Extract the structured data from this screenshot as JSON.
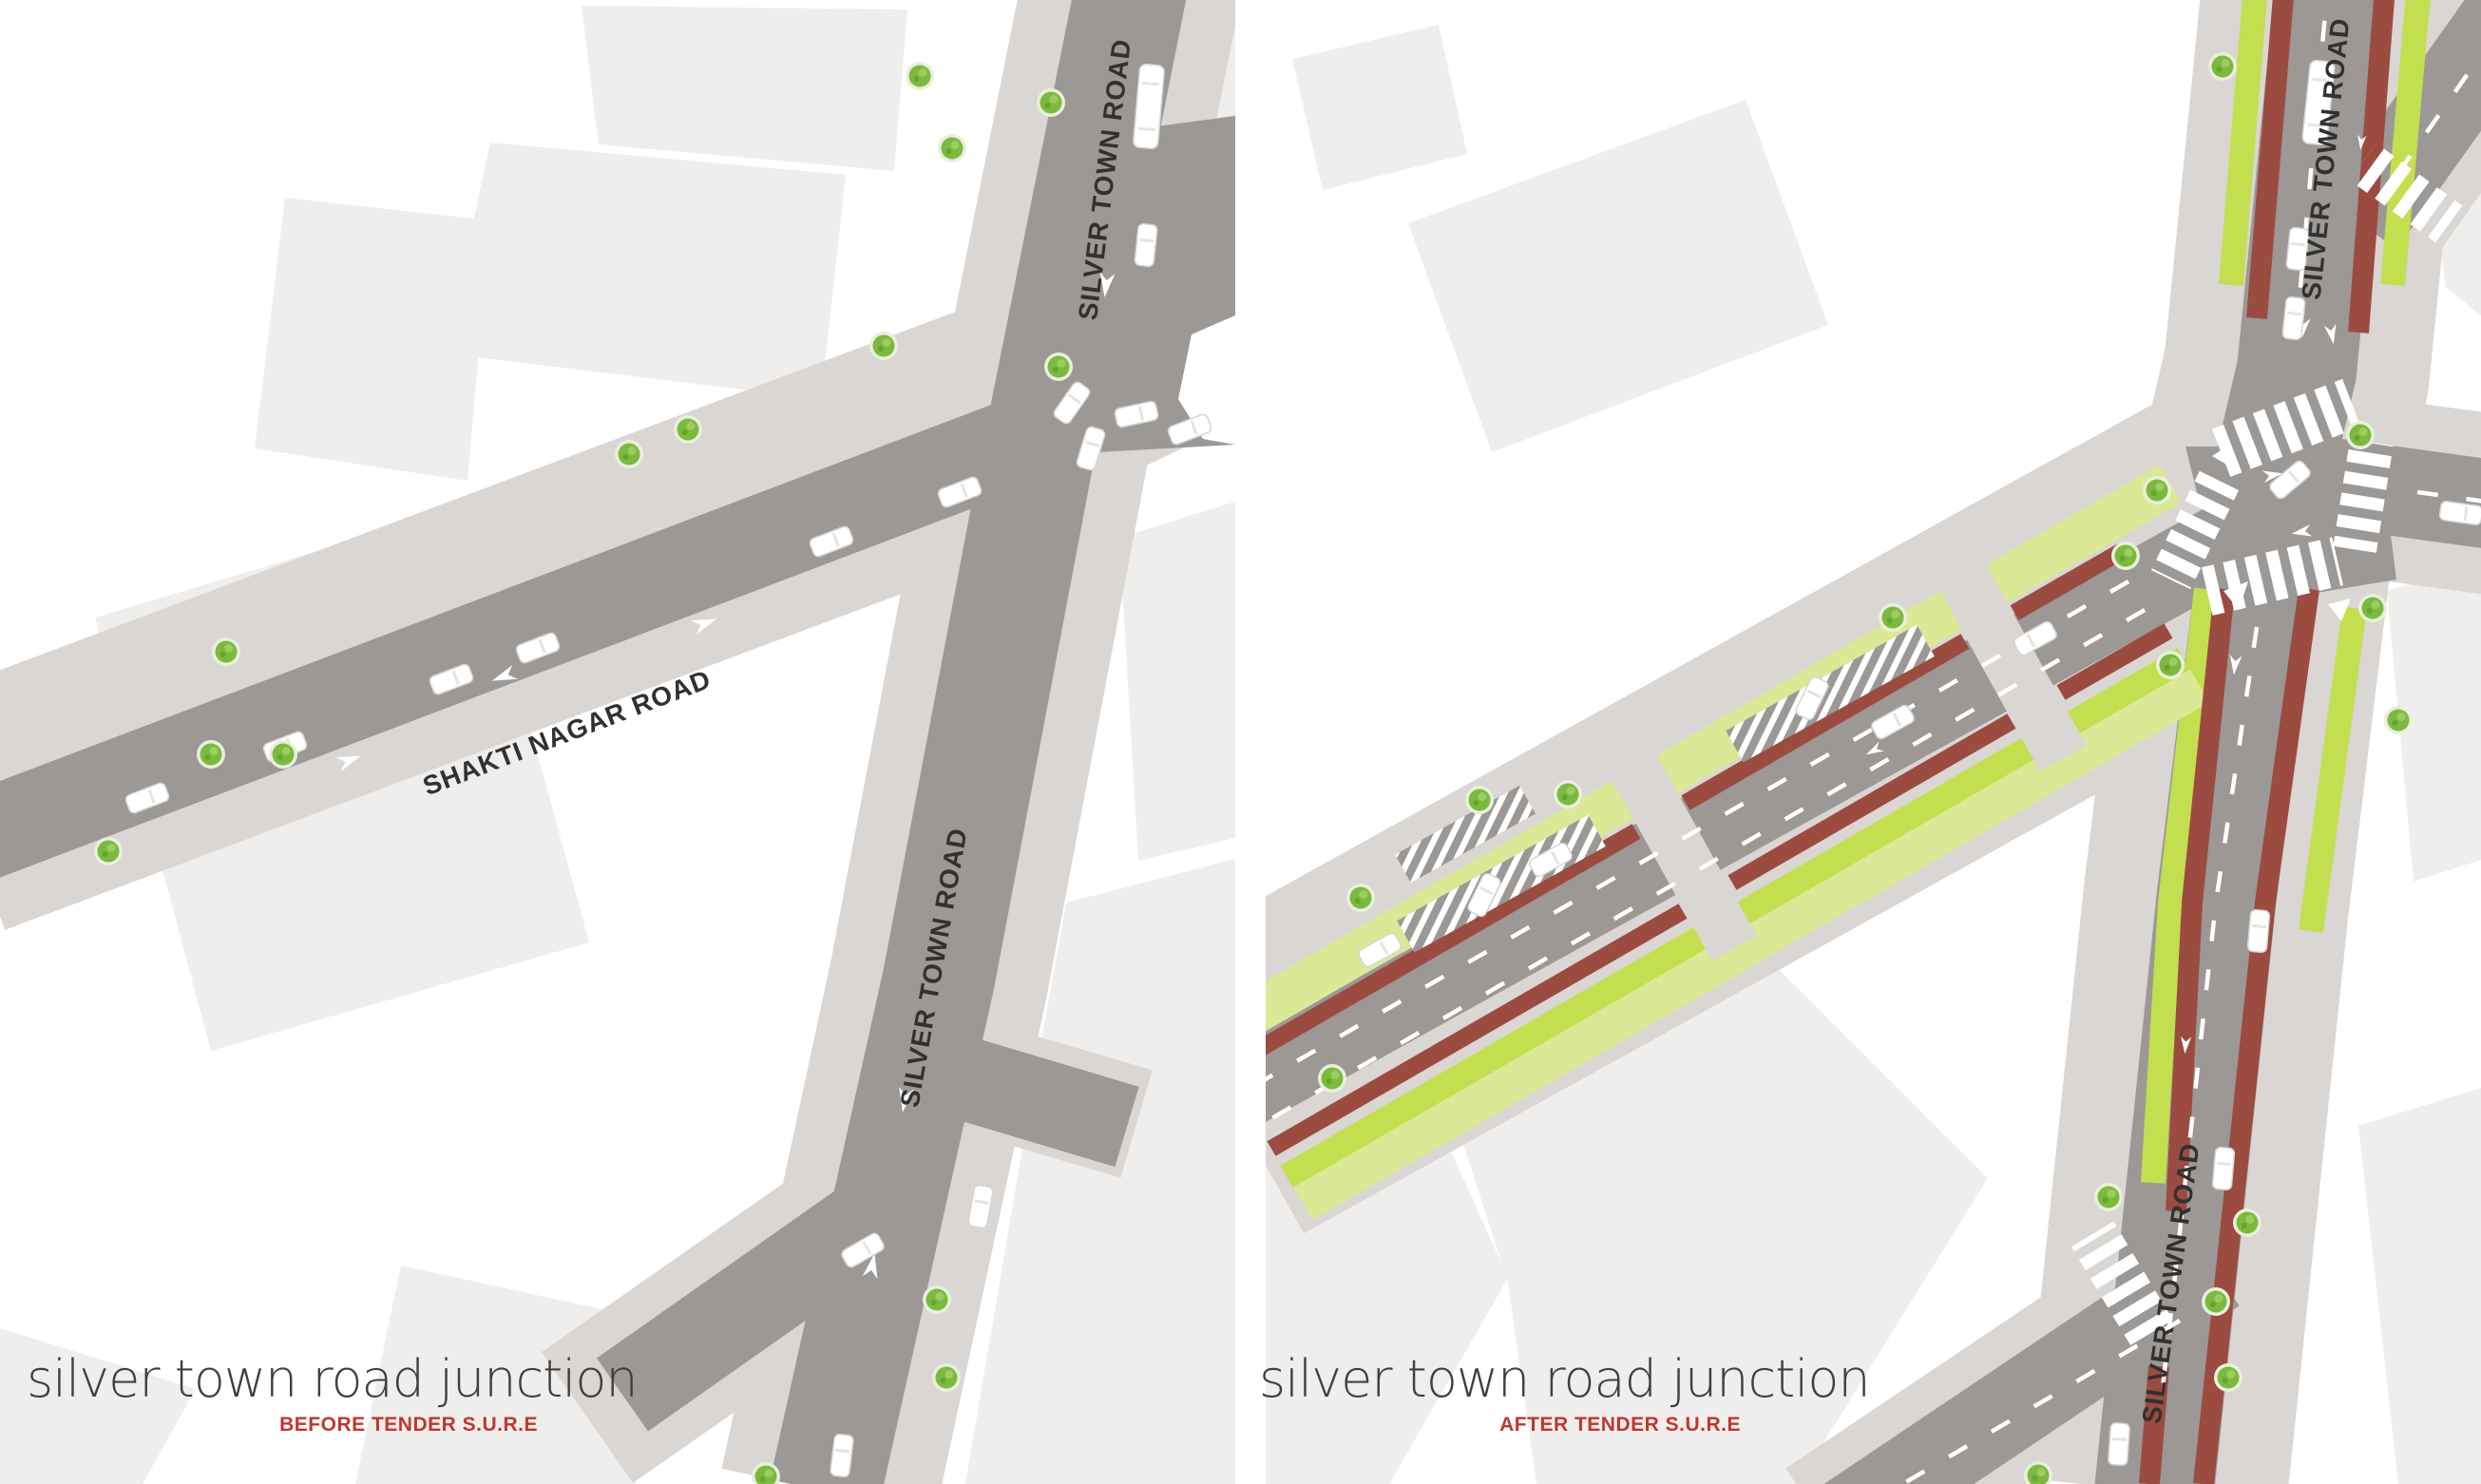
{
  "colors": {
    "bg": "#ffffff",
    "road": "#9b9896",
    "sidewalk": "#d9d6d3",
    "building": "#efeeec",
    "cycle_red": "#9c4b41",
    "verge_lime": "#c3df4f",
    "verge_lime_pale": "#dbe996",
    "tree_green": "#7cb93f",
    "tree_halo": "#e8f0dc",
    "car_white": "#ffffff",
    "label_dark": "#33312f",
    "title_dark": "#413f3e",
    "accent_red": "#c0362c"
  },
  "left": {
    "title": "silver town road junction",
    "subtitle": "BEFORE TENDER S.U.R.E",
    "road_labels": [
      "SILVER TOWN ROAD",
      "SHAKTI NAGAR ROAD",
      "SILVER TOWN ROAD"
    ]
  },
  "right": {
    "title": "silver town road junction",
    "subtitle": "AFTER TENDER S.U.R.E",
    "road_labels": [
      "SILVER TOWN ROAD",
      "SILVER TOWN ROAD"
    ]
  }
}
